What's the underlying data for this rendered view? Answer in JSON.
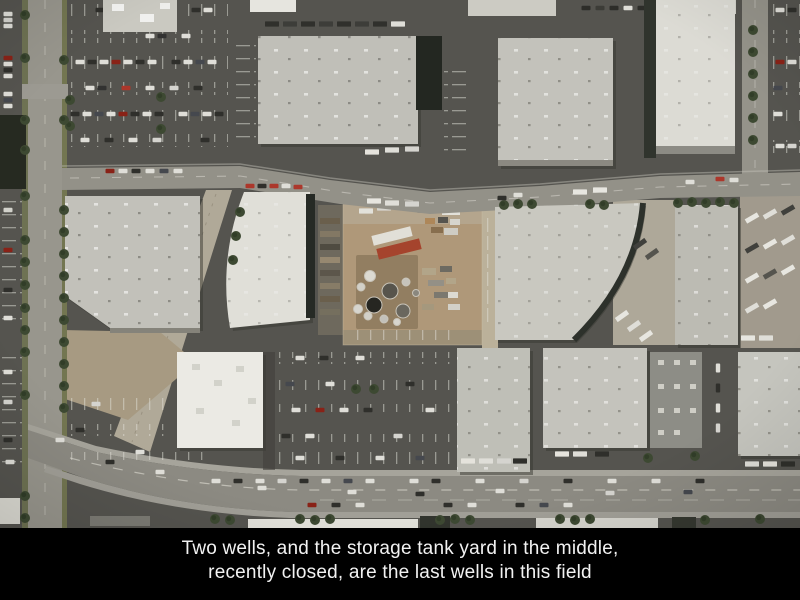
{
  "caption": {
    "line1": "Two wells, and the storage tank yard in the middle,",
    "line2": "recently closed, are the last wells in this field"
  },
  "colors": {
    "caption-bg": "#000000",
    "caption-text": "#f2f2f2"
  }
}
